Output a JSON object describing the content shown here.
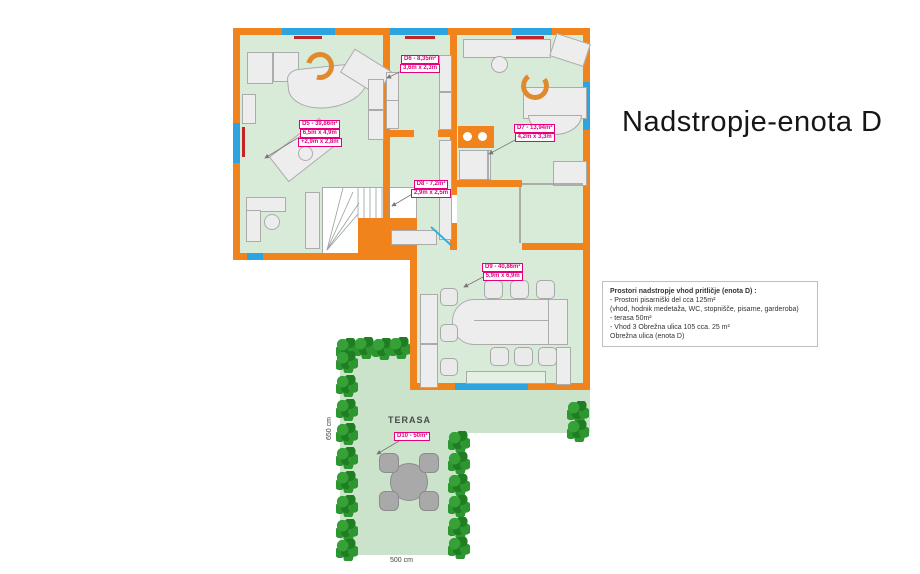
{
  "title": "Nadstropje-enota D",
  "info_box": {
    "heading": "Prostori nadstropje vhod pritličje (enota D) :",
    "lines": [
      "- Prostori pisarniški del cca 125m²",
      "(vhod, hodnik medetaža, WC, stopnišče, pisarne, garderoba)",
      "- terasa 50m²",
      "- Vhod 3  Obrežna ulica 105 cca. 25 m²",
      "Obrežna ulica (enota  D)"
    ]
  },
  "room_labels": {
    "d5": {
      "area": "D5 - 39,86m²",
      "dims": "6,5m x 4,9m",
      "dims2": "+2,9m x 2,8m"
    },
    "d6": {
      "area": "D6 - 8,35m²",
      "dims": "3,6m x 2,3m"
    },
    "d7": {
      "area": "D7 - 13,94m²",
      "dims": "4,2m x 3,3m"
    },
    "d8": {
      "area": "D8 - 7,2m²",
      "dims": "2,9m x 2,5m"
    },
    "d9": {
      "area": "D9 - 40,86m²",
      "dims": "5,9m x 6,9m"
    },
    "d10": {
      "area": "D10 - 50m²"
    }
  },
  "terrace": {
    "name": "TERASA",
    "dim_bottom": "500 cm",
    "dim_left": "650 cm"
  },
  "colors": {
    "wall": "#F0831C",
    "room_floor": "#D8EAD8",
    "terrace_floor": "#CBE3CB",
    "window": "#2BA4DF",
    "radiator": "#C22428",
    "label": "#E6007E",
    "tree": "#2E9630"
  }
}
